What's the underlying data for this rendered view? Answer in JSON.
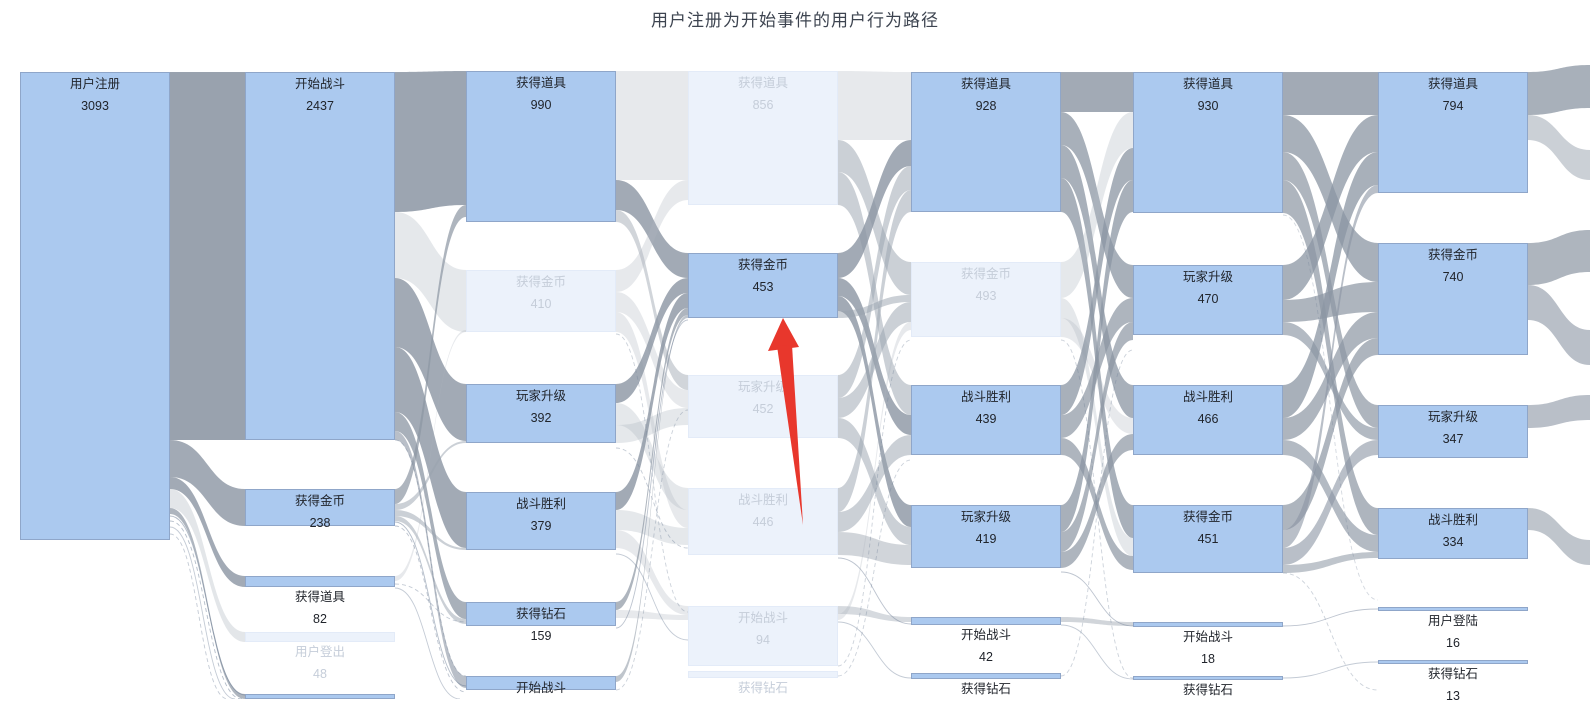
{
  "chart_data": {
    "type": "sankey",
    "title": "用户注册为开始事件的用户行为路径",
    "legend_position": "none",
    "grid": false,
    "highlighted_path_node": {
      "label": "获得金币",
      "value": 453,
      "column": 4
    },
    "colors": {
      "node_fill": "#abc9ef",
      "node_border": "#8fa6c9",
      "node_faded_fill": "#ecf2fb",
      "link_dark": "#8b95a3",
      "link_mid": "#98a2ae",
      "link_light": "#aeb6c0",
      "annotation_arrow": "#e8372c",
      "title_color": "#3d4450"
    },
    "nodes": [
      {
        "c": 1,
        "x": 20,
        "w": 150,
        "y": 72,
        "h": 468,
        "label": "用户注册",
        "value": "3093",
        "state": "normal"
      },
      {
        "c": 2,
        "x": 245,
        "w": 150,
        "y": 72,
        "h": 368,
        "label": "开始战斗",
        "value": "2437",
        "state": "normal"
      },
      {
        "c": 2,
        "x": 245,
        "w": 150,
        "y": 489,
        "h": 37,
        "label": "获得金币",
        "value": "238",
        "state": "normal"
      },
      {
        "c": 2,
        "x": 245,
        "w": 150,
        "y": 576,
        "h": 11,
        "label": "获得道具",
        "value": "82",
        "state": "normal"
      },
      {
        "c": 2,
        "x": 245,
        "w": 150,
        "y": 632,
        "h": 10,
        "label": "用户登出",
        "value": "48",
        "state": "faded"
      },
      {
        "c": 2,
        "x": 245,
        "w": 150,
        "y": 694,
        "h": 5,
        "label": "",
        "value": "",
        "state": "normal"
      },
      {
        "c": 3,
        "x": 466,
        "w": 150,
        "y": 71,
        "h": 151,
        "label": "获得道具",
        "value": "990",
        "state": "normal"
      },
      {
        "c": 3,
        "x": 466,
        "w": 150,
        "y": 270,
        "h": 62,
        "label": "获得金币",
        "value": "410",
        "state": "faded"
      },
      {
        "c": 3,
        "x": 466,
        "w": 150,
        "y": 384,
        "h": 59,
        "label": "玩家升级",
        "value": "392",
        "state": "normal"
      },
      {
        "c": 3,
        "x": 466,
        "w": 150,
        "y": 492,
        "h": 58,
        "label": "战斗胜利",
        "value": "379",
        "state": "normal"
      },
      {
        "c": 3,
        "x": 466,
        "w": 150,
        "y": 602,
        "h": 24,
        "label": "获得钻石",
        "value": "159",
        "state": "normal"
      },
      {
        "c": 3,
        "x": 466,
        "w": 150,
        "y": 676,
        "h": 14,
        "label": "开始战斗",
        "value": "",
        "state": "normal"
      },
      {
        "c": 4,
        "x": 688,
        "w": 150,
        "y": 71,
        "h": 134,
        "label": "获得道具",
        "value": "856",
        "state": "faded"
      },
      {
        "c": 4,
        "x": 688,
        "w": 150,
        "y": 253,
        "h": 65,
        "label": "获得金币",
        "value": "453",
        "state": "normal"
      },
      {
        "c": 4,
        "x": 688,
        "w": 150,
        "y": 375,
        "h": 63,
        "label": "玩家升级",
        "value": "452",
        "state": "faded"
      },
      {
        "c": 4,
        "x": 688,
        "w": 150,
        "y": 488,
        "h": 67,
        "label": "战斗胜利",
        "value": "446",
        "state": "faded"
      },
      {
        "c": 4,
        "x": 688,
        "w": 150,
        "y": 606,
        "h": 60,
        "label": "开始战斗",
        "value": "94",
        "state": "faded"
      },
      {
        "c": 4,
        "x": 688,
        "w": 150,
        "y": 671,
        "h": 7,
        "label": "获得钻石",
        "value": "",
        "state": "faded"
      },
      {
        "c": 5,
        "x": 911,
        "w": 150,
        "y": 72,
        "h": 140,
        "label": "获得道具",
        "value": "928",
        "state": "normal"
      },
      {
        "c": 5,
        "x": 911,
        "w": 150,
        "y": 262,
        "h": 75,
        "label": "获得金币",
        "value": "493",
        "state": "faded"
      },
      {
        "c": 5,
        "x": 911,
        "w": 150,
        "y": 385,
        "h": 70,
        "label": "战斗胜利",
        "value": "439",
        "state": "normal"
      },
      {
        "c": 5,
        "x": 911,
        "w": 150,
        "y": 505,
        "h": 63,
        "label": "玩家升级",
        "value": "419",
        "state": "normal"
      },
      {
        "c": 5,
        "x": 911,
        "w": 150,
        "y": 617,
        "h": 8,
        "label": "开始战斗",
        "value": "42",
        "state": "normal"
      },
      {
        "c": 5,
        "x": 911,
        "w": 150,
        "y": 673,
        "h": 6,
        "label": "获得钻石",
        "value": "",
        "state": "normal"
      },
      {
        "c": 6,
        "x": 1133,
        "w": 150,
        "y": 72,
        "h": 141,
        "label": "获得道具",
        "value": "930",
        "state": "normal"
      },
      {
        "c": 6,
        "x": 1133,
        "w": 150,
        "y": 265,
        "h": 70,
        "label": "玩家升级",
        "value": "470",
        "state": "normal"
      },
      {
        "c": 6,
        "x": 1133,
        "w": 150,
        "y": 385,
        "h": 70,
        "label": "战斗胜利",
        "value": "466",
        "state": "normal"
      },
      {
        "c": 6,
        "x": 1133,
        "w": 150,
        "y": 505,
        "h": 68,
        "label": "获得金币",
        "value": "451",
        "state": "normal"
      },
      {
        "c": 6,
        "x": 1133,
        "w": 150,
        "y": 622,
        "h": 5,
        "label": "开始战斗",
        "value": "18",
        "state": "normal"
      },
      {
        "c": 6,
        "x": 1133,
        "w": 150,
        "y": 676,
        "h": 4,
        "label": "获得钻石",
        "value": "",
        "state": "normal"
      },
      {
        "c": 7,
        "x": 1378,
        "w": 150,
        "y": 72,
        "h": 121,
        "label": "获得道具",
        "value": "794",
        "state": "normal"
      },
      {
        "c": 7,
        "x": 1378,
        "w": 150,
        "y": 243,
        "h": 112,
        "label": "获得金币",
        "value": "740",
        "state": "normal"
      },
      {
        "c": 7,
        "x": 1378,
        "w": 150,
        "y": 405,
        "h": 53,
        "label": "玩家升级",
        "value": "347",
        "state": "normal"
      },
      {
        "c": 7,
        "x": 1378,
        "w": 150,
        "y": 508,
        "h": 51,
        "label": "战斗胜利",
        "value": "334",
        "state": "normal"
      },
      {
        "c": 7,
        "x": 1378,
        "w": 150,
        "y": 607,
        "h": 4,
        "label": "用户登陆",
        "value": "16",
        "state": "normal"
      },
      {
        "c": 7,
        "x": 1378,
        "w": 150,
        "y": 660,
        "h": 4,
        "label": "获得钻石",
        "value": "13",
        "state": "normal"
      }
    ],
    "links": [
      [
        170,
        245,
        72,
        440,
        72,
        440,
        "g",
        0.88
      ],
      [
        170,
        245,
        440,
        477,
        489,
        526,
        "g",
        0.8
      ],
      [
        170,
        245,
        477,
        489,
        576,
        587,
        "g",
        0.8
      ],
      [
        170,
        245,
        489,
        508,
        632,
        642,
        "lt",
        0.35
      ],
      [
        170,
        245,
        508,
        514,
        694,
        699,
        "g",
        0.7
      ],
      [
        395,
        466,
        72,
        212,
        71,
        205,
        "g",
        0.85
      ],
      [
        395,
        466,
        212,
        278,
        270,
        332,
        "lt",
        0.32
      ],
      [
        395,
        466,
        278,
        347,
        384,
        441,
        "g",
        0.8
      ],
      [
        395,
        466,
        347,
        412,
        492,
        548,
        "g",
        0.8
      ],
      [
        395,
        466,
        412,
        431,
        602,
        619,
        "g",
        0.75
      ],
      [
        395,
        466,
        431,
        440,
        676,
        688,
        "g",
        0.6
      ],
      [
        395,
        466,
        489,
        504,
        205,
        217,
        "g",
        0.7
      ],
      [
        395,
        466,
        504,
        510,
        441,
        443,
        "md",
        0.5
      ],
      [
        395,
        466,
        510,
        516,
        548,
        550,
        "md",
        0.5
      ],
      [
        395,
        466,
        516,
        521,
        619,
        624,
        "md",
        0.5
      ],
      [
        395,
        466,
        576,
        581,
        330,
        332,
        "lt",
        0.3
      ],
      [
        616,
        688,
        71,
        180,
        71,
        180,
        "lt",
        0.3
      ],
      [
        616,
        688,
        180,
        210,
        253,
        278,
        "g",
        0.8
      ],
      [
        616,
        688,
        210,
        222,
        375,
        390,
        "md",
        0.45
      ],
      [
        616,
        688,
        270,
        292,
        180,
        200,
        "lt",
        0.3
      ],
      [
        616,
        688,
        292,
        312,
        390,
        408,
        "lt",
        0.3
      ],
      [
        616,
        688,
        312,
        332,
        510,
        528,
        "lt",
        0.3
      ],
      [
        616,
        688,
        384,
        403,
        278,
        293,
        "g",
        0.8
      ],
      [
        616,
        688,
        403,
        425,
        488,
        510,
        "lt",
        0.32
      ],
      [
        616,
        688,
        425,
        443,
        408,
        425,
        "lt",
        0.32
      ],
      [
        616,
        688,
        492,
        510,
        293,
        308,
        "g",
        0.8
      ],
      [
        616,
        688,
        510,
        530,
        528,
        545,
        "lt",
        0.32
      ],
      [
        616,
        688,
        530,
        548,
        606,
        615,
        "lt",
        0.3
      ],
      [
        616,
        688,
        602,
        610,
        308,
        315,
        "g",
        0.7
      ],
      [
        616,
        688,
        610,
        618,
        615,
        620,
        "lt",
        0.3
      ],
      [
        616,
        688,
        676,
        682,
        315,
        318,
        "g",
        0.55
      ],
      [
        838,
        911,
        71,
        140,
        72,
        140,
        "lt",
        0.3
      ],
      [
        838,
        911,
        140,
        172,
        262,
        295,
        "md",
        0.5
      ],
      [
        838,
        911,
        172,
        205,
        385,
        415,
        "md",
        0.5
      ],
      [
        838,
        911,
        253,
        278,
        140,
        166,
        "g",
        0.8
      ],
      [
        838,
        911,
        278,
        296,
        415,
        435,
        "g",
        0.8
      ],
      [
        838,
        911,
        296,
        311,
        505,
        527,
        "g",
        0.8
      ],
      [
        838,
        911,
        311,
        318,
        295,
        302,
        "md",
        0.5
      ],
      [
        838,
        911,
        375,
        398,
        166,
        190,
        "md",
        0.5
      ],
      [
        838,
        911,
        398,
        418,
        302,
        322,
        "md",
        0.5
      ],
      [
        838,
        911,
        418,
        438,
        527,
        545,
        "md",
        0.5
      ],
      [
        838,
        911,
        488,
        512,
        190,
        212,
        "md",
        0.5
      ],
      [
        838,
        911,
        512,
        532,
        435,
        455,
        "md",
        0.5
      ],
      [
        838,
        911,
        532,
        555,
        545,
        565,
        "md",
        0.45
      ],
      [
        838,
        911,
        606,
        614,
        617,
        622,
        "md",
        0.4
      ],
      [
        838,
        911,
        614,
        620,
        322,
        330,
        "lt",
        0.3
      ],
      [
        1061,
        1133,
        72,
        112,
        72,
        112,
        "g",
        0.8
      ],
      [
        1061,
        1133,
        112,
        145,
        265,
        298,
        "g",
        0.75
      ],
      [
        1061,
        1133,
        145,
        178,
        385,
        418,
        "g",
        0.75
      ],
      [
        1061,
        1133,
        178,
        212,
        505,
        538,
        "g",
        0.75
      ],
      [
        1061,
        1133,
        262,
        298,
        112,
        148,
        "lt",
        0.32
      ],
      [
        1061,
        1133,
        298,
        318,
        538,
        556,
        "lt",
        0.32
      ],
      [
        1061,
        1133,
        318,
        337,
        418,
        434,
        "lt",
        0.3
      ],
      [
        1061,
        1133,
        385,
        415,
        148,
        180,
        "g",
        0.75
      ],
      [
        1061,
        1133,
        415,
        438,
        298,
        322,
        "g",
        0.7
      ],
      [
        1061,
        1133,
        438,
        455,
        556,
        570,
        "g",
        0.7
      ],
      [
        1061,
        1133,
        505,
        532,
        180,
        212,
        "g",
        0.75
      ],
      [
        1061,
        1133,
        532,
        552,
        322,
        340,
        "g",
        0.7
      ],
      [
        1061,
        1133,
        552,
        568,
        434,
        450,
        "g",
        0.7
      ],
      [
        1061,
        1133,
        617,
        622,
        622,
        626,
        "md",
        0.45
      ],
      [
        1283,
        1378,
        72,
        115,
        72,
        115,
        "g",
        0.8
      ],
      [
        1283,
        1378,
        115,
        152,
        243,
        282,
        "g",
        0.75
      ],
      [
        1283,
        1378,
        152,
        180,
        405,
        428,
        "g",
        0.7
      ],
      [
        1283,
        1378,
        180,
        213,
        508,
        535,
        "g",
        0.7
      ],
      [
        1283,
        1378,
        265,
        300,
        115,
        152,
        "g",
        0.75
      ],
      [
        1283,
        1378,
        300,
        322,
        282,
        312,
        "g",
        0.7
      ],
      [
        1283,
        1378,
        322,
        335,
        428,
        440,
        "g",
        0.65
      ],
      [
        1283,
        1378,
        385,
        418,
        152,
        185,
        "g",
        0.75
      ],
      [
        1283,
        1378,
        418,
        440,
        312,
        338,
        "g",
        0.7
      ],
      [
        1283,
        1378,
        440,
        455,
        535,
        552,
        "g",
        0.65
      ],
      [
        1283,
        1378,
        505,
        530,
        338,
        355,
        "g",
        0.7
      ],
      [
        1283,
        1378,
        530,
        548,
        185,
        193,
        "g",
        0.6
      ],
      [
        1283,
        1378,
        548,
        565,
        440,
        455,
        "g",
        0.6
      ],
      [
        1283,
        1378,
        565,
        573,
        552,
        558,
        "g",
        0.55
      ],
      [
        1528,
        1590,
        72,
        115,
        65,
        108,
        "g",
        0.75
      ],
      [
        1528,
        1590,
        115,
        140,
        150,
        180,
        "md",
        0.5
      ],
      [
        1528,
        1590,
        243,
        285,
        230,
        272,
        "g",
        0.7
      ],
      [
        1528,
        1590,
        285,
        320,
        330,
        365,
        "g",
        0.6
      ],
      [
        1528,
        1590,
        405,
        428,
        395,
        420,
        "g",
        0.6
      ],
      [
        1528,
        1590,
        508,
        530,
        540,
        565,
        "g",
        0.55
      ]
    ],
    "lines": [
      [
        170,
        516,
        245,
        695,
        0,
        0.5
      ],
      [
        170,
        521,
        242,
        699,
        1,
        0.5
      ],
      [
        170,
        527,
        235,
        699,
        0,
        0.4
      ],
      [
        170,
        534,
        228,
        699,
        1,
        0.4
      ],
      [
        395,
        522,
        466,
        686,
        0,
        0.5
      ],
      [
        395,
        526,
        466,
        692,
        1,
        0.45
      ],
      [
        395,
        584,
        466,
        622,
        1,
        0.4
      ],
      [
        395,
        588,
        460,
        699,
        0,
        0.4
      ],
      [
        395,
        440,
        466,
        676,
        1,
        0.35
      ],
      [
        616,
        448,
        688,
        548,
        1,
        0.4
      ],
      [
        616,
        554,
        688,
        640,
        0,
        0.4
      ],
      [
        616,
        628,
        688,
        320,
        0,
        0.45
      ],
      [
        616,
        690,
        688,
        410,
        1,
        0.35
      ],
      [
        616,
        334,
        688,
        612,
        1,
        0.35
      ],
      [
        838,
        558,
        911,
        624,
        0,
        0.45
      ],
      [
        838,
        622,
        911,
        678,
        0,
        0.4
      ],
      [
        838,
        666,
        911,
        340,
        1,
        0.35
      ],
      [
        838,
        676,
        911,
        460,
        1,
        0.35
      ],
      [
        1061,
        572,
        1133,
        626,
        0,
        0.45
      ],
      [
        1061,
        625,
        1133,
        679,
        0,
        0.4
      ],
      [
        1061,
        676,
        1133,
        350,
        1,
        0.35
      ],
      [
        1061,
        340,
        1133,
        678,
        1,
        0.35
      ],
      [
        1283,
        626,
        1378,
        609,
        0,
        0.45
      ],
      [
        1283,
        678,
        1378,
        662,
        0,
        0.4
      ],
      [
        1283,
        573,
        1378,
        690,
        1,
        0.35
      ],
      [
        1283,
        215,
        1378,
        600,
        1,
        0.3
      ]
    ],
    "annotation_arrow": {
      "color": "#e8372c",
      "head_points": "783,318 768,351 799,347",
      "shaft_points": "777,346 792,345 803,525"
    }
  }
}
